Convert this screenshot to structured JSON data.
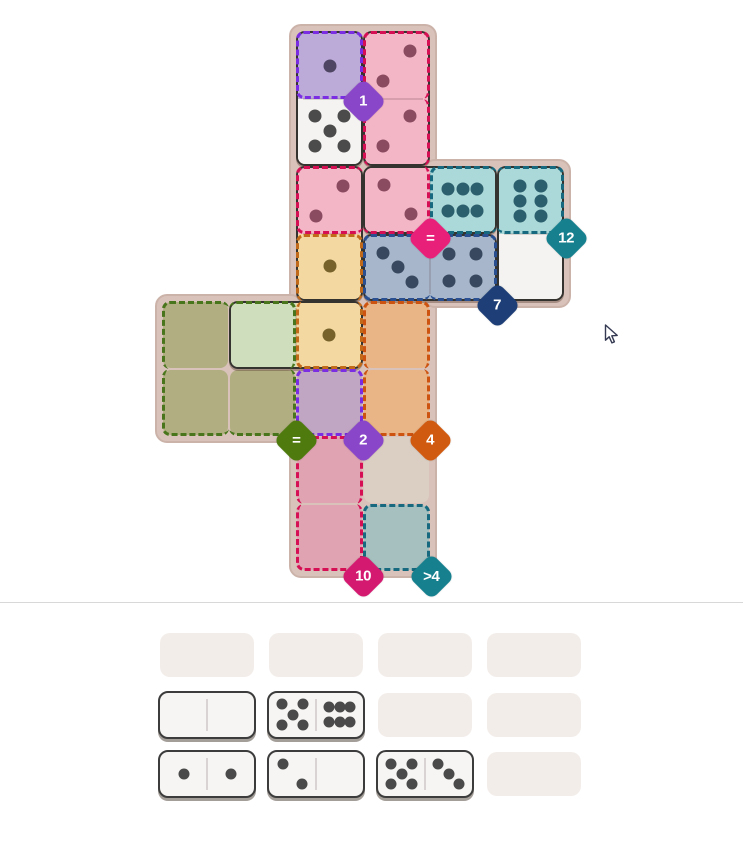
{
  "game": {
    "title": "domino fit puzzle",
    "board_panels": [
      {
        "x": 289,
        "y": 24,
        "w": 148,
        "h": 554
      },
      {
        "x": 423,
        "y": 159,
        "w": 148,
        "h": 149
      },
      {
        "x": 155,
        "y": 294,
        "w": 148,
        "h": 149
      }
    ],
    "regions": {
      "purple": {
        "dash": "#7a2de2",
        "empty": "#c0a6c2",
        "placed": "#bcabd9",
        "pip": "#4e4563"
      },
      "pink": {
        "dash": "#d60f55",
        "empty": "#dfa3b2",
        "placed": "#f3b6c6",
        "pip": "#8a4a60"
      },
      "teal": {
        "dash": "#16697e",
        "empty": "#a5c0bf",
        "placed": "#abd8d8",
        "pip": "#2b5f6d"
      },
      "navy": {
        "dash": "#2a5091",
        "empty": "#a7b6ca",
        "placed": "#a7b6ca",
        "pip": "#38485e"
      },
      "amber": {
        "dash": "#c06a1a",
        "empty": "#f3d8a2",
        "placed": "#f3d8a2",
        "pip": "#76622a"
      },
      "orange": {
        "dash": "#cd5310",
        "empty": "#e9b586",
        "placed": "#e9b586",
        "pip": "#76622a"
      },
      "green": {
        "dash": "#49761c",
        "empty": "#b1ae82",
        "placed": "#cfdfbd",
        "pip": "#5a6a3a"
      },
      "white": {
        "dash": "none",
        "empty": "#f4f3f1",
        "placed": "#f4f3f1",
        "pip": "#4b4b4b"
      },
      "plain": {
        "dash": "none",
        "empty": "#dbcec3",
        "placed": "#dbcec3",
        "pip": "#4b4b4b"
      }
    },
    "empty_cells": [
      {
        "r": 4,
        "c": 0,
        "region": "green"
      },
      {
        "r": 5,
        "c": 0,
        "region": "green"
      },
      {
        "r": 5,
        "c": 1,
        "region": "green"
      },
      {
        "r": 4,
        "c": 3,
        "region": "orange"
      },
      {
        "r": 5,
        "c": 3,
        "region": "orange"
      },
      {
        "r": 5,
        "c": 2,
        "region": "purple"
      },
      {
        "r": 6,
        "c": 2,
        "region": "pink"
      },
      {
        "r": 7,
        "c": 2,
        "region": "pink"
      },
      {
        "r": 7,
        "c": 3,
        "region": "teal"
      },
      {
        "r": 6,
        "c": 3,
        "region": "plain"
      }
    ],
    "board_dominoes": [
      {
        "name": "domino-1-5",
        "halves": [
          {
            "r": 0,
            "c": 2,
            "v": 1,
            "var": "1",
            "region": "purple"
          },
          {
            "r": 1,
            "c": 2,
            "v": 5,
            "var": "5",
            "region": "white"
          }
        ]
      },
      {
        "name": "domino-2-2",
        "halves": [
          {
            "r": 0,
            "c": 3,
            "v": 2,
            "var": "2tr",
            "region": "pink"
          },
          {
            "r": 1,
            "c": 3,
            "v": 2,
            "var": "2tr",
            "region": "pink"
          }
        ]
      },
      {
        "name": "domino-2-1",
        "halves": [
          {
            "r": 2,
            "c": 2,
            "v": 2,
            "var": "2tr",
            "region": "pink"
          },
          {
            "r": 3,
            "c": 2,
            "v": 1,
            "var": "1",
            "region": "amber"
          }
        ]
      },
      {
        "name": "domino-2-6",
        "halves": [
          {
            "r": 2,
            "c": 3,
            "v": 2,
            "var": "2tl",
            "region": "pink"
          },
          {
            "r": 2,
            "c": 4,
            "v": 6,
            "var": "6h",
            "region": "teal"
          }
        ]
      },
      {
        "name": "domino-6-0",
        "halves": [
          {
            "r": 2,
            "c": 5,
            "v": 6,
            "var": "6v",
            "region": "teal"
          },
          {
            "r": 3,
            "c": 5,
            "v": 0,
            "var": "0",
            "region": "white"
          }
        ]
      },
      {
        "name": "domino-3-4",
        "halves": [
          {
            "r": 3,
            "c": 3,
            "v": 3,
            "var": "3",
            "region": "navy"
          },
          {
            "r": 3,
            "c": 4,
            "v": 4,
            "var": "4",
            "region": "navy"
          }
        ]
      },
      {
        "name": "domino-0-1",
        "halves": [
          {
            "r": 4,
            "c": 1,
            "v": 0,
            "var": "0",
            "region": "green"
          },
          {
            "r": 4,
            "c": 2,
            "v": 1,
            "var": "1",
            "region": "amber"
          }
        ]
      }
    ],
    "region_dashes": [
      {
        "region": "purple",
        "r": 0,
        "c": 2,
        "sides": "trbl"
      },
      {
        "region": "pink",
        "r": 0,
        "c": 3,
        "sides": "trl"
      },
      {
        "region": "pink",
        "r": 1,
        "c": 3,
        "sides": "rl"
      },
      {
        "region": "pink",
        "r": 2,
        "c": 2,
        "sides": "tlb"
      },
      {
        "region": "pink",
        "r": 2,
        "c": 3,
        "sides": "rb"
      },
      {
        "region": "teal",
        "r": 2,
        "c": 4,
        "sides": "tlb"
      },
      {
        "region": "teal",
        "r": 2,
        "c": 5,
        "sides": "trb"
      },
      {
        "region": "navy",
        "r": 3,
        "c": 3,
        "sides": "tlb"
      },
      {
        "region": "navy",
        "r": 3,
        "c": 4,
        "sides": "trb"
      },
      {
        "region": "amber",
        "r": 3,
        "c": 2,
        "sides": "trl"
      },
      {
        "region": "amber",
        "r": 4,
        "c": 2,
        "sides": "rbl"
      },
      {
        "region": "orange",
        "r": 4,
        "c": 3,
        "sides": "trl"
      },
      {
        "region": "orange",
        "r": 5,
        "c": 3,
        "sides": "rbl"
      },
      {
        "region": "green",
        "r": 4,
        "c": 0,
        "sides": "tl"
      },
      {
        "region": "green",
        "r": 4,
        "c": 1,
        "sides": "tr"
      },
      {
        "region": "green",
        "r": 5,
        "c": 0,
        "sides": "lb"
      },
      {
        "region": "green",
        "r": 5,
        "c": 1,
        "sides": "rb"
      },
      {
        "region": "purple",
        "r": 5,
        "c": 2,
        "sides": "trbl"
      },
      {
        "region": "pink",
        "r": 6,
        "c": 2,
        "sides": "trl"
      },
      {
        "region": "pink",
        "r": 7,
        "c": 2,
        "sides": "rbl"
      },
      {
        "region": "teal",
        "r": 7,
        "c": 3,
        "sides": "trbl"
      }
    ],
    "badges": [
      {
        "label": "1",
        "color": "#8a46c8",
        "x": 363,
        "y": 101
      },
      {
        "label": "=",
        "color": "#e8207a",
        "x": 430,
        "y": 238
      },
      {
        "label": "12",
        "color": "#17808f",
        "x": 566,
        "y": 238
      },
      {
        "label": "7",
        "color": "#1d3e76",
        "x": 497,
        "y": 305
      },
      {
        "label": "=",
        "color": "#4e7a0e",
        "x": 296,
        "y": 440
      },
      {
        "label": "2",
        "color": "#8a46c8",
        "x": 363,
        "y": 440
      },
      {
        "label": "4",
        "color": "#d05a10",
        "x": 430,
        "y": 440
      },
      {
        "label": "10",
        "color": "#d41a70",
        "x": 363,
        "y": 576
      },
      {
        "label": ">4",
        "color": "#17808f",
        "x": 431,
        "y": 576
      }
    ],
    "pip_vars": {
      "0": [],
      "1": [
        [
          50,
          50
        ]
      ],
      "2tr": [
        [
          71,
          27
        ],
        [
          29,
          73
        ]
      ],
      "2tl": [
        [
          29,
          27
        ],
        [
          71,
          73
        ]
      ],
      "3": [
        [
          27,
          27
        ],
        [
          50,
          50
        ],
        [
          73,
          73
        ]
      ],
      "4": [
        [
          29,
          29
        ],
        [
          71,
          29
        ],
        [
          29,
          71
        ],
        [
          71,
          71
        ]
      ],
      "5": [
        [
          27,
          27
        ],
        [
          73,
          27
        ],
        [
          50,
          50
        ],
        [
          27,
          73
        ],
        [
          73,
          73
        ]
      ],
      "6h": [
        [
          27,
          33
        ],
        [
          50,
          33
        ],
        [
          73,
          33
        ],
        [
          27,
          67
        ],
        [
          50,
          67
        ],
        [
          73,
          67
        ]
      ],
      "6v": [
        [
          33,
          27
        ],
        [
          67,
          27
        ],
        [
          33,
          50
        ],
        [
          67,
          50
        ],
        [
          33,
          73
        ],
        [
          67,
          73
        ]
      ]
    },
    "tray": {
      "slot_color": "#f3edea",
      "tile_fill": "#f6f5f3",
      "pip_color": "#4a4a4a",
      "rows": 3,
      "cols": 4,
      "dominoes": [
        {
          "row": 1,
          "col": 0,
          "name": "tray-domino-0-0",
          "halves": [
            {
              "v": 0,
              "var": "0"
            },
            {
              "v": 0,
              "var": "0"
            }
          ]
        },
        {
          "row": 1,
          "col": 1,
          "name": "tray-domino-5-6",
          "halves": [
            {
              "v": 5,
              "var": "5"
            },
            {
              "v": 6,
              "var": "6h"
            }
          ]
        },
        {
          "row": 2,
          "col": 0,
          "name": "tray-domino-1-1",
          "halves": [
            {
              "v": 1,
              "var": "1"
            },
            {
              "v": 1,
              "var": "1"
            }
          ]
        },
        {
          "row": 2,
          "col": 1,
          "name": "tray-domino-2-0",
          "halves": [
            {
              "v": 2,
              "var": "2tl"
            },
            {
              "v": 0,
              "var": "0"
            }
          ]
        },
        {
          "row": 2,
          "col": 2,
          "name": "tray-domino-5-3",
          "halves": [
            {
              "v": 5,
              "var": "5"
            },
            {
              "v": 3,
              "var": "3"
            }
          ]
        }
      ]
    }
  }
}
